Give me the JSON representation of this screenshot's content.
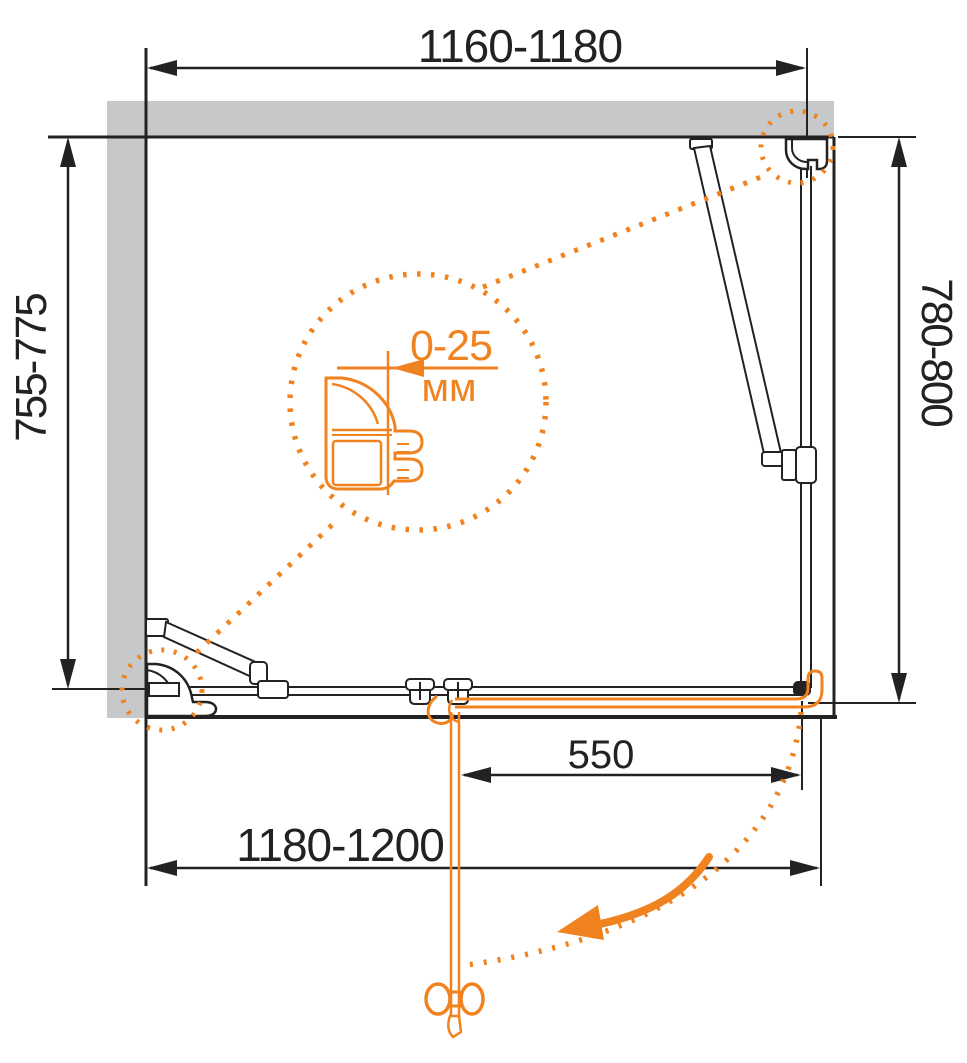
{
  "drawing": {
    "type": "shower-enclosure-installation-plan",
    "dimensions": {
      "top_width": "1160-1180",
      "left_depth": "755-775",
      "right_depth": "780-800",
      "door_width": "550",
      "bottom_width": "1180-1200"
    },
    "detail": {
      "adjustment_range": "0-25",
      "unit": "мм"
    },
    "colors": {
      "accent_orange": "#F0821F",
      "wall_gray": "#C7C8CA",
      "line_black": "#242122"
    }
  }
}
